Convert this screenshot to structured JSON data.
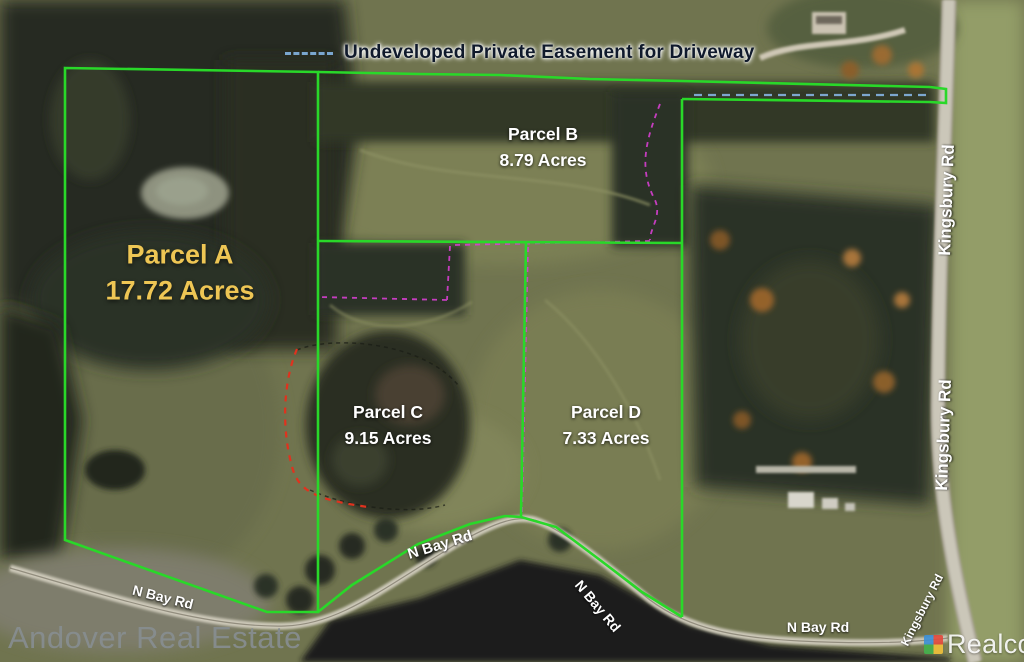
{
  "legend": {
    "label": "Undeveloped Private Easement for Driveway"
  },
  "parcels": [
    {
      "id": "A",
      "name": "Parcel A",
      "acres": "17.72 Acres"
    },
    {
      "id": "B",
      "name": "Parcel B",
      "acres": "8.79 Acres"
    },
    {
      "id": "C",
      "name": "Parcel C",
      "acres": "9.15 Acres"
    },
    {
      "id": "D",
      "name": "Parcel D",
      "acres": "7.33 Acres"
    }
  ],
  "roads": {
    "kingsbury": "Kingsbury Rd",
    "n_bay": "N Bay Rd"
  },
  "watermarks": {
    "brand": "Andover Real Estate",
    "provider": "Realcomp"
  },
  "colors": {
    "parcel_boundary": "#29d829",
    "easement_legend_dash": "#7aa6cf",
    "easement_on_map": "#d63fd0",
    "wetland_marking": "#e0321e",
    "parcel_a_text": "#eec654",
    "parcel_text": "#ffffff"
  }
}
